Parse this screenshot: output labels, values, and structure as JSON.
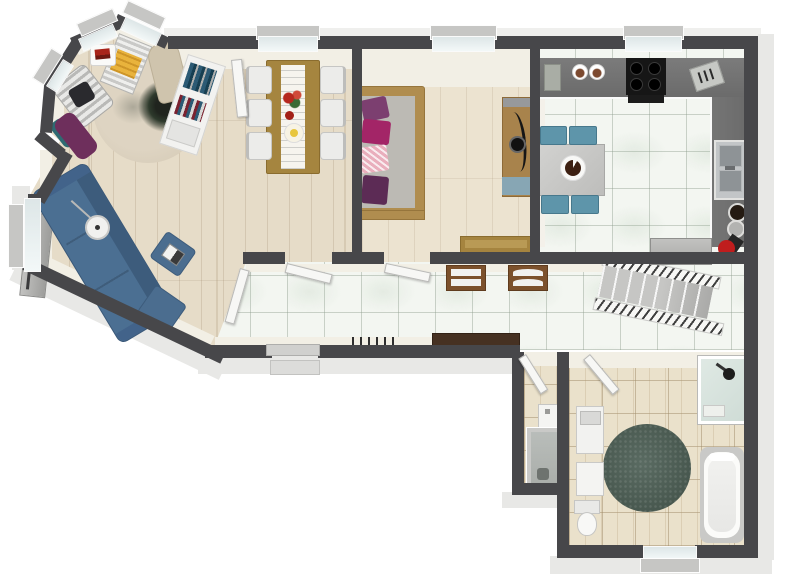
{
  "title": "3d-floor-plan-render",
  "view": "angled-top-down",
  "background": "#ffffff",
  "palette": {
    "wall": "#47474a",
    "wood_floor": "#e6dcc8",
    "bedroom_floor": "#ece3d0",
    "white_tile": "#f3f6f1",
    "beige_tile": "#eae1cb",
    "counter_gray": "#6e6e6e",
    "sofa_blue": "#4b6f92",
    "chair_teal": "#5e95aa",
    "bath_rug_green": "#4d5f57",
    "bay_rug_beige": "#d9cfbd",
    "bed_wood": "#b08d4f",
    "pillow_purple": "#7c3f70",
    "pillow_magenta": "#a32567",
    "lounge_yellow": "#e9b33c",
    "vacuum_red": "#bf1d1d",
    "doormat_brown": "#463122"
  },
  "rooms": [
    {
      "name": "bay-sitting-area",
      "floor": "wood",
      "windows": 3,
      "items": [
        "striped-armchair",
        "dark-pillow",
        "yellow-striped-lounge",
        "white-side-table",
        "red-books",
        "beige-chaise",
        "purple-chaise",
        "teal-cushion",
        "floral-round-rug",
        "potted-plant"
      ]
    },
    {
      "name": "dining-room",
      "floor": "wood",
      "windows": 1,
      "items": [
        "wooden-dining-table",
        "white-table-runner",
        "red-flower-bouquet",
        "fruit-plate",
        "white-chair-x6",
        "tilted-bookshelf"
      ]
    },
    {
      "name": "living-room",
      "floor": "wood",
      "windows": 1,
      "items": [
        "blue-sectional-sofa",
        "blue-ottoman-with-laptop",
        "blue-ottoman",
        "floor-lamp",
        "tv-lowboard"
      ]
    },
    {
      "name": "bedroom",
      "floor": "wood",
      "windows": 1,
      "items": [
        "double-bed",
        "gray-mattress",
        "purple-pillow",
        "magenta-pillow",
        "pink-pattern-pillow",
        "dark-purple-pillow",
        "wardrobe-with-mirror",
        "wooden-desk"
      ]
    },
    {
      "name": "kitchen",
      "floor": "white-tile",
      "windows": 1,
      "items": [
        "l-shaped-counter",
        "cooktop-4-burner",
        "cutting-board",
        "food-bowl-x2",
        "knife-board",
        "double-sink",
        "pet-bowl-dark",
        "pet-bowl-gray",
        "vacuum-cleaner",
        "gray-cabinet",
        "gray-table",
        "blue-chair-x4",
        "brown-plate"
      ]
    },
    {
      "name": "hallway",
      "floor": "white-tile",
      "windows": 0,
      "items": [
        "staircase-with-railings",
        "shoe-rack-1",
        "shoe-rack-2",
        "coat-hooks",
        "doormat",
        "front-door-step"
      ]
    },
    {
      "name": "wc",
      "floor": "beige-tile",
      "windows": 0,
      "items": [
        "shower-stall",
        "small-sink"
      ]
    },
    {
      "name": "bathroom",
      "floor": "beige-tile",
      "windows": 1,
      "items": [
        "corner-shower",
        "bathtub",
        "green-round-rug",
        "vanity-sink",
        "white-cabinet",
        "toilet"
      ]
    }
  ],
  "doors": [
    "bay-door",
    "dining-door",
    "bedroom-door",
    "living-room-door",
    "front-door",
    "wc-door",
    "bathroom-door"
  ],
  "windows_total": 8
}
